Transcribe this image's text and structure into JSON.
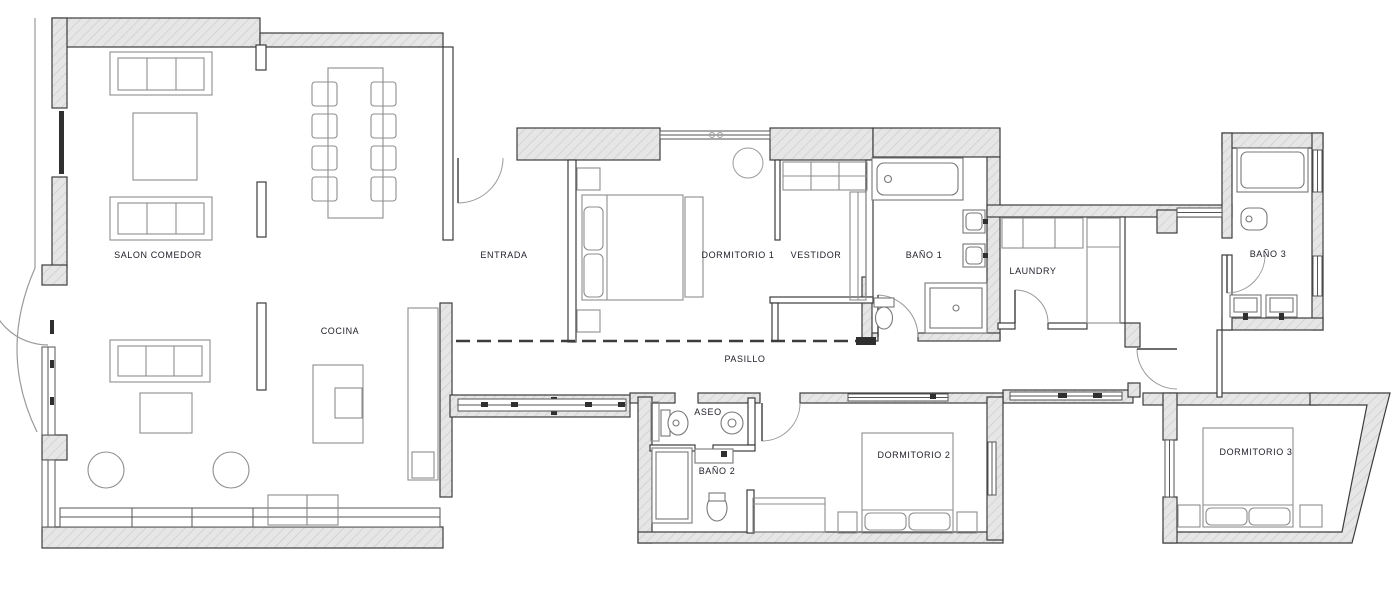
{
  "rooms": [
    {
      "id": "salon-comedor",
      "label": "SALON COMEDOR"
    },
    {
      "id": "cocina",
      "label": "COCINA"
    },
    {
      "id": "entrada",
      "label": "ENTRADA"
    },
    {
      "id": "dormitorio-1",
      "label": "DORMITORIO 1"
    },
    {
      "id": "vestidor",
      "label": "VESTIDOR"
    },
    {
      "id": "bano-1",
      "label": "BAÑO 1"
    },
    {
      "id": "laundry",
      "label": "LAUNDRY"
    },
    {
      "id": "bano-3",
      "label": "BAÑO 3"
    },
    {
      "id": "pasillo",
      "label": "PASILLO"
    },
    {
      "id": "aseo",
      "label": "ASEO"
    },
    {
      "id": "bano-2",
      "label": "BAÑO 2"
    },
    {
      "id": "dormitorio-2",
      "label": "DORMITORIO 2"
    },
    {
      "id": "dormitorio-3",
      "label": "DORMITORIO 3"
    }
  ],
  "colors": {
    "background": "#ffffff",
    "wall_fill": "#e6e6e6",
    "wall_hatch": "#cccccc",
    "wall_outline": "#3c3c3c",
    "furniture_stroke": "#8e8e8e",
    "fixture_stroke": "#777777",
    "window_stroke": "#555555",
    "door_arc": "#9a9a9a",
    "label_text": "#20202b"
  }
}
